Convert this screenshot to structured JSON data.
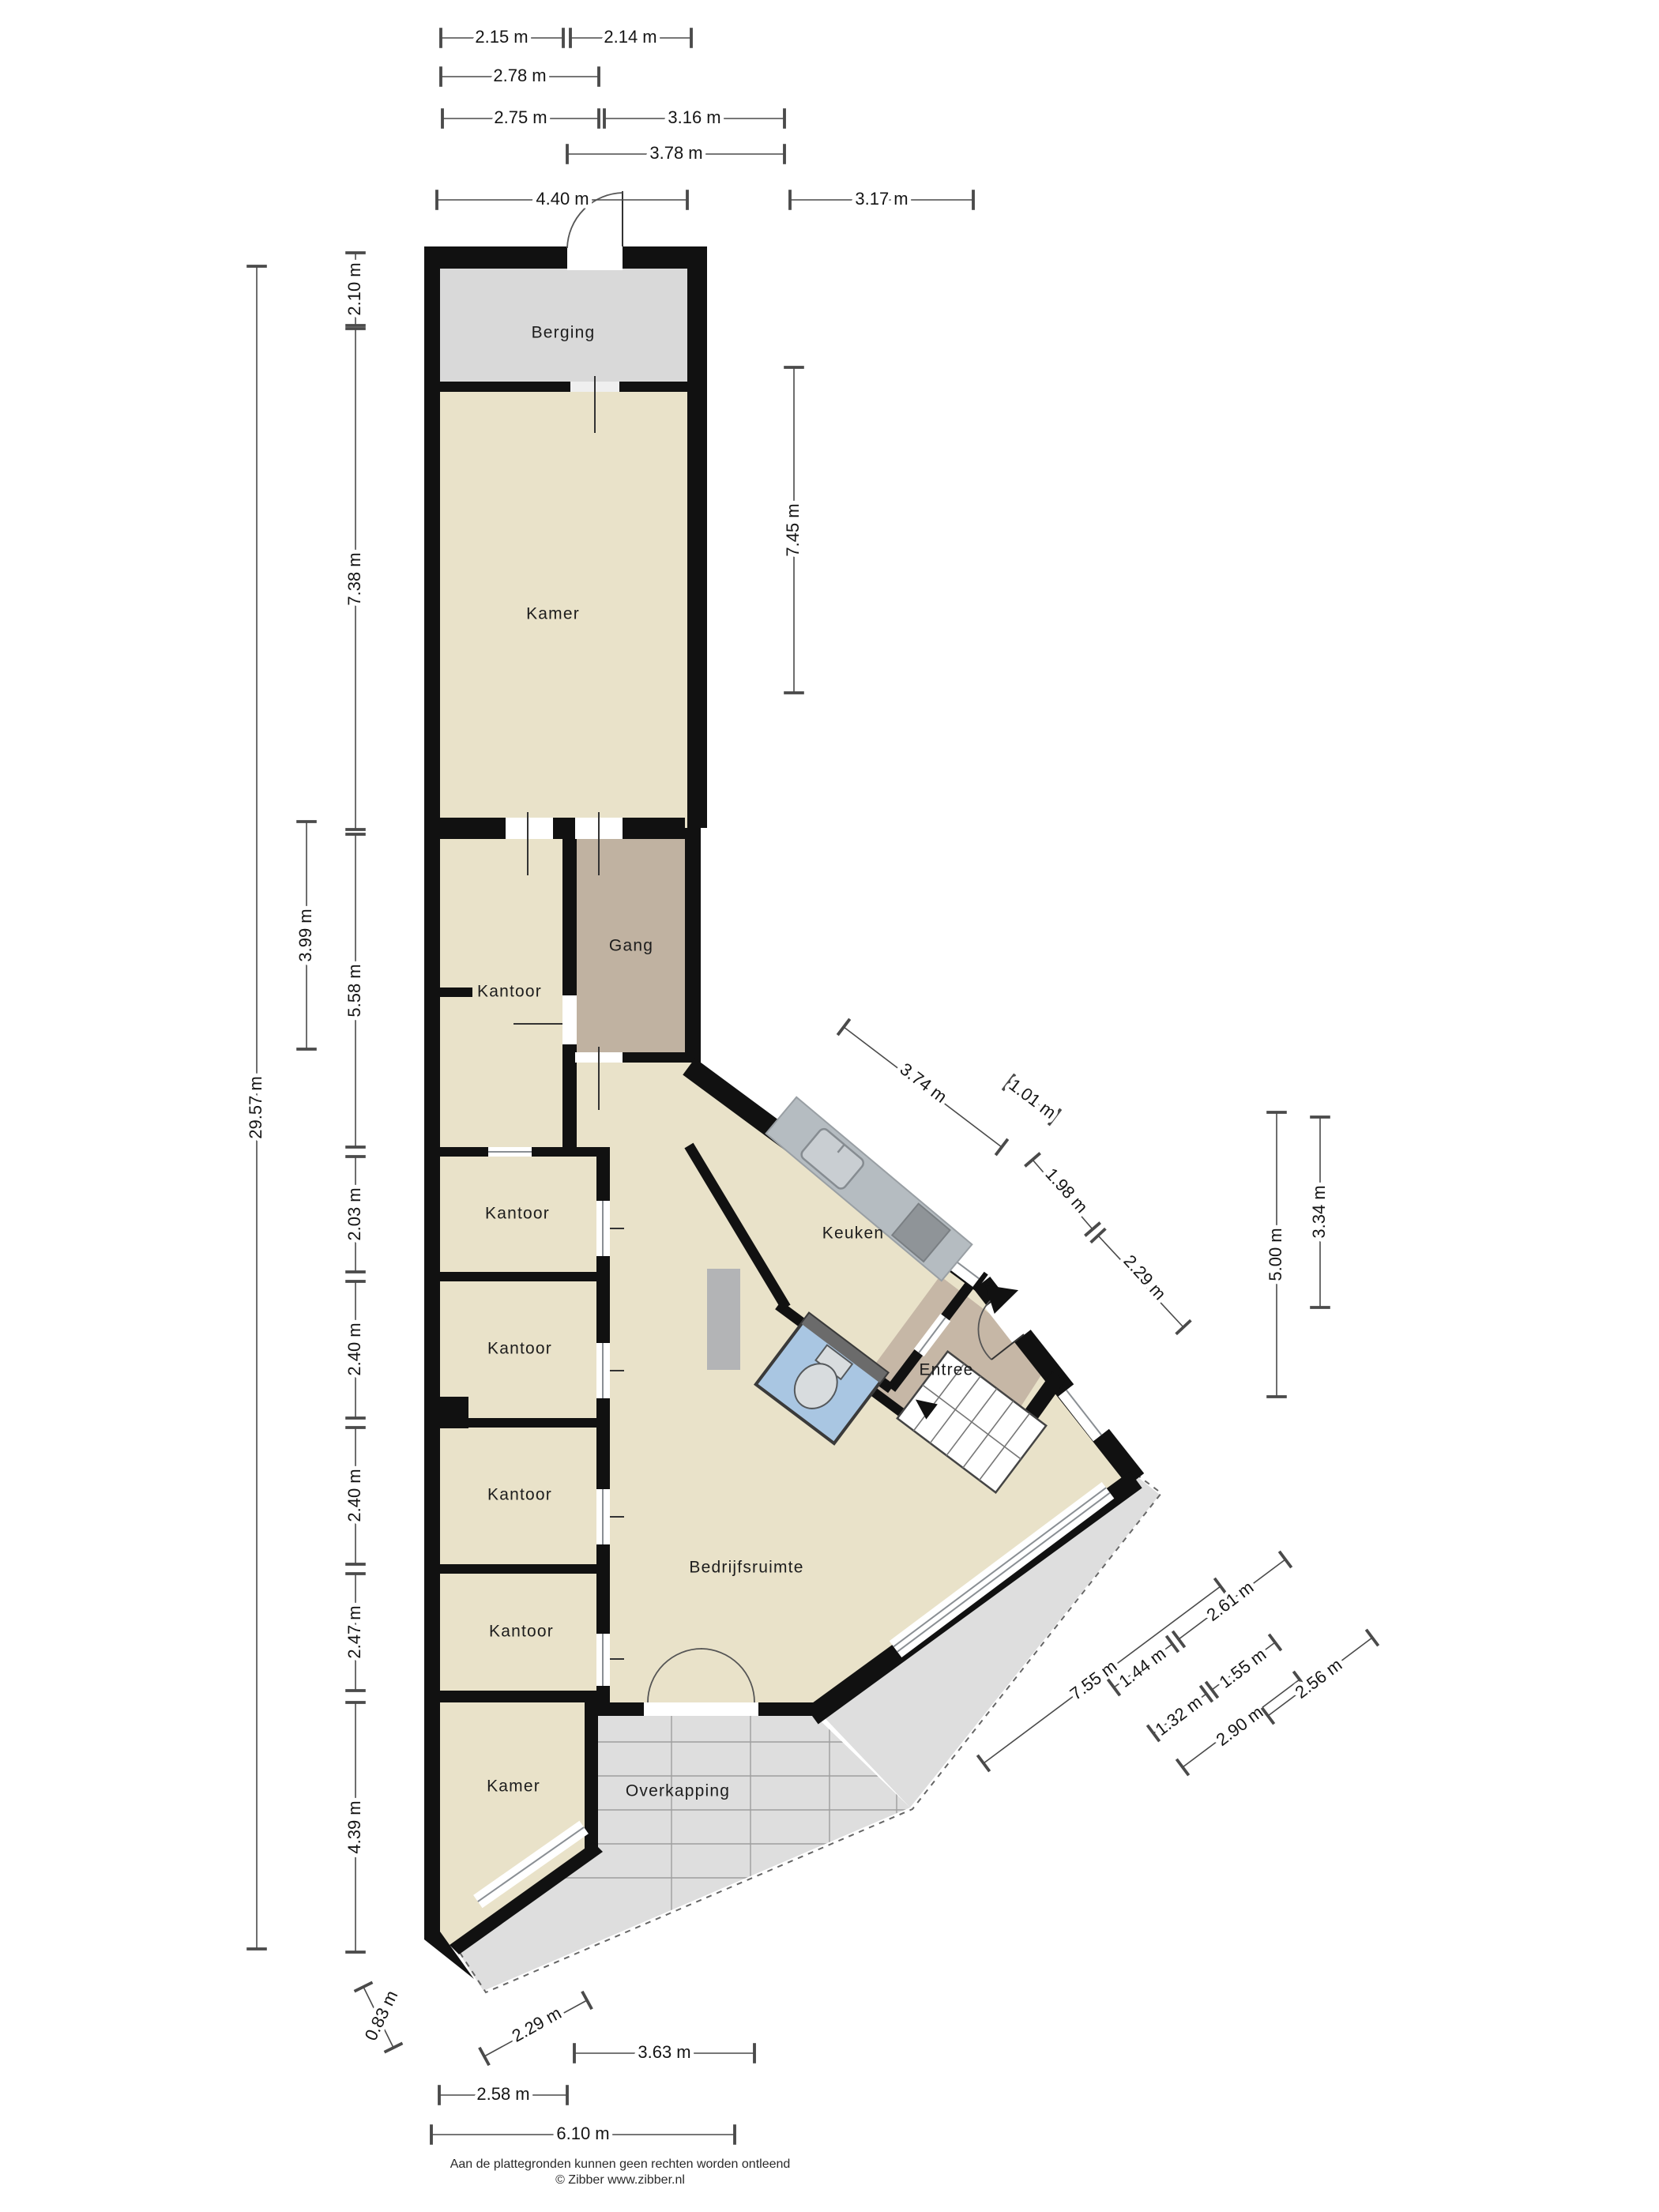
{
  "rooms": {
    "berging": {
      "label": "Berging"
    },
    "kamer_top": {
      "label": "Kamer"
    },
    "kantoor_1": {
      "label": "Kantoor"
    },
    "gang": {
      "label": "Gang"
    },
    "kantoor_2": {
      "label": "Kantoor"
    },
    "kantoor_3": {
      "label": "Kantoor"
    },
    "kantoor_4": {
      "label": "Kantoor"
    },
    "kantoor_5": {
      "label": "Kantoor"
    },
    "kamer_bottom": {
      "label": "Kamer"
    },
    "keuken": {
      "label": "Keuken"
    },
    "entree": {
      "label": "Entree"
    },
    "bedrijfsruimte": {
      "label": "Bedrijfsruimte"
    },
    "overkapping": {
      "label": "Overkapping"
    }
  },
  "dimensions": {
    "top": [
      "2.15 m",
      "2.14 m",
      "2.78 m",
      "2.75 m",
      "3.16 m",
      "3.78 m",
      "4.40 m",
      "3.17 m"
    ],
    "left": [
      "2.10 m",
      "7.38 m",
      "29.57 m",
      "3.99 m",
      "5.58 m",
      "2.03 m",
      "2.40 m",
      "2.40 m",
      "2.47 m",
      "4.39 m"
    ],
    "middle": [
      "7.45 m"
    ],
    "right": [
      "5.00 m",
      "3.34 m"
    ],
    "ne": [
      "3.74 m",
      "1.01 m",
      "1.98 m",
      "2.29 m"
    ],
    "se": [
      "7.55 m",
      "1.44 m",
      "2.61 m",
      "1.32 m",
      "1.55 m",
      "2.90 m",
      "2.56 m"
    ],
    "bottom": [
      "0.83 m",
      "2.29 m",
      "3.63 m",
      "2.58 m",
      "6.10 m"
    ]
  },
  "colors": {
    "wall": "#111111",
    "floor_beige": "#e9e2c9",
    "berging_grey": "#d9d9d9",
    "gang_brown": "#c0b2a1",
    "entree_brown": "#c6b7a6",
    "toilet_blue": "#a9c6e2",
    "overkapping_grey": "#dedede",
    "counter_grey": "#b5bcc1"
  },
  "footer": {
    "line1": "Aan de plattegronden kunnen geen rechten worden ontleend",
    "line2": "© Zibber www.zibber.nl"
  }
}
